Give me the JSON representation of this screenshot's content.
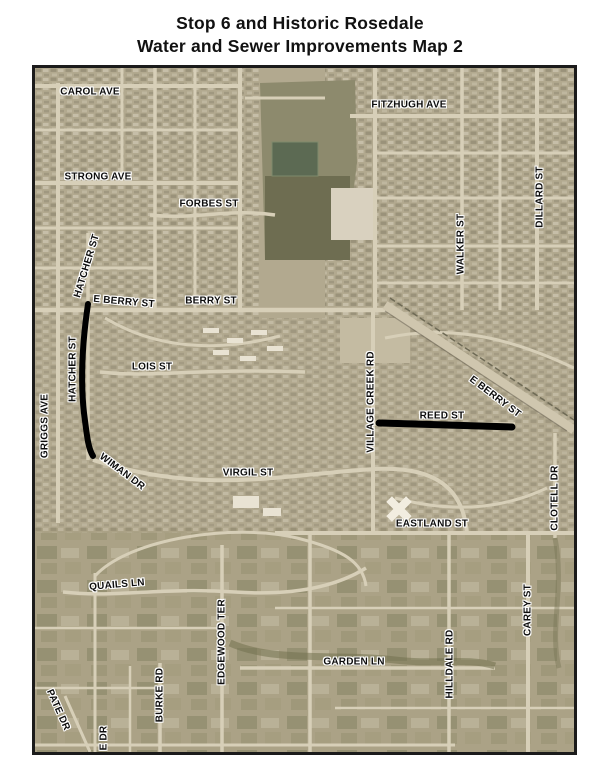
{
  "title": {
    "line1": "Stop 6 and Historic Rosedale",
    "line2": "Water and Sewer Improvements Map 2"
  },
  "map": {
    "colors": {
      "improvement_line": "#000000",
      "label_text": "#0d0d0d",
      "label_halo": "#ffffff",
      "map_border": "#1b1b1b",
      "basemap_tan": "#b2a98f",
      "pond_green": "#5c6a53"
    },
    "street_labels": [
      {
        "text": "CAROL AVE",
        "x": 55,
        "y": 24,
        "rot": 0
      },
      {
        "text": "FITZHUGH AVE",
        "x": 374,
        "y": 37,
        "rot": 0
      },
      {
        "text": "STRONG AVE",
        "x": 63,
        "y": 109,
        "rot": 0
      },
      {
        "text": "FORBES ST",
        "x": 174,
        "y": 136,
        "rot": 0
      },
      {
        "text": "DILLARD ST",
        "x": 505,
        "y": 129,
        "rot": -90
      },
      {
        "text": "WALKER ST",
        "x": 426,
        "y": 176,
        "rot": -90
      },
      {
        "text": "HATCHER ST",
        "x": 52,
        "y": 198,
        "rot": -73
      },
      {
        "text": "E BERRY ST",
        "x": 89,
        "y": 234,
        "rot": 5
      },
      {
        "text": "BERRY ST",
        "x": 176,
        "y": 233,
        "rot": 0
      },
      {
        "text": "HATCHER ST",
        "x": 38,
        "y": 301,
        "rot": -90
      },
      {
        "text": "LOIS ST",
        "x": 117,
        "y": 299,
        "rot": 0
      },
      {
        "text": "VILLAGE CREEK RD",
        "x": 336,
        "y": 334,
        "rot": -90
      },
      {
        "text": "E BERRY ST",
        "x": 460,
        "y": 329,
        "rot": 37
      },
      {
        "text": "REED ST",
        "x": 407,
        "y": 348,
        "rot": 0
      },
      {
        "text": "GRIGGS AVE",
        "x": 10,
        "y": 358,
        "rot": -90
      },
      {
        "text": "WIMAN DR",
        "x": 87,
        "y": 404,
        "rot": 37
      },
      {
        "text": "VIRGIL ST",
        "x": 213,
        "y": 405,
        "rot": 0
      },
      {
        "text": "CLOTELL DR",
        "x": 520,
        "y": 430,
        "rot": -90
      },
      {
        "text": "EASTLAND ST",
        "x": 397,
        "y": 456,
        "rot": 0
      },
      {
        "text": "QUAILS LN",
        "x": 82,
        "y": 517,
        "rot": -5
      },
      {
        "text": "EDGEWOOD TER",
        "x": 187,
        "y": 574,
        "rot": -90
      },
      {
        "text": "GARDEN LN",
        "x": 319,
        "y": 594,
        "rot": 0
      },
      {
        "text": "CAREY ST",
        "x": 493,
        "y": 542,
        "rot": -90
      },
      {
        "text": "HILLDALE RD",
        "x": 415,
        "y": 596,
        "rot": -90
      },
      {
        "text": "BURKE RD",
        "x": 125,
        "y": 627,
        "rot": -90
      },
      {
        "text": "PATE DR",
        "x": 23,
        "y": 642,
        "rot": 66
      },
      {
        "text": "E DR",
        "x": 69,
        "y": 670,
        "rot": -90
      }
    ],
    "improvement_lines": [
      {
        "name": "hatcher-st-improvement-line",
        "path": "M53,236 C48,270 45,310 49,345 C52,368 53,380 58,388",
        "stroke_width": 6
      },
      {
        "name": "reed-st-improvement-line",
        "path": "M344,355 L477,359",
        "stroke_width": 7
      }
    ]
  }
}
